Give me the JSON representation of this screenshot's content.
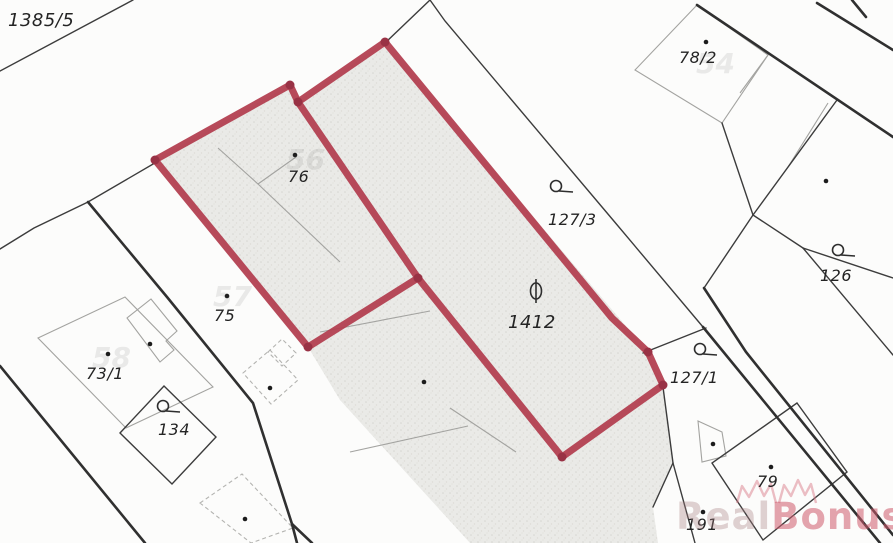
{
  "map": {
    "type": "cadastral-map",
    "labels": {
      "p1385_5": "1385/5",
      "p78_2": "78/2",
      "p76": "76",
      "p127_3": "127/3",
      "p126": "126",
      "p75": "75",
      "p73_1": "73/1",
      "p134": "134",
      "p1412": "1412",
      "p127_1": "127/1",
      "p79": "79",
      "p191": "191"
    },
    "faint_building_numbers": {
      "f56": "56",
      "f57": "57",
      "f58": "58",
      "f54": "54"
    },
    "symbols": [
      {
        "name": "circle-flag-symbol",
        "near_parcel": "127/3"
      },
      {
        "name": "circle-flag-symbol",
        "near_parcel": "126"
      },
      {
        "name": "circle-flag-symbol",
        "near_parcel": "134"
      },
      {
        "name": "circle-flag-symbol",
        "near_parcel": "127/1"
      },
      {
        "name": "theta-symbol",
        "near_parcel": "1412"
      }
    ],
    "highlighted_parcels": [
      "76-area",
      "1412-strip"
    ],
    "colors": {
      "highlight_red": "#b23c4e",
      "highlight_red_dark": "#993245",
      "parcel_fill_gray": "#eaeae7",
      "line_dark": "#3c3c3c",
      "line_light": "#9f9f9f",
      "watermark_pink": "#cd5a6c"
    },
    "watermark": {
      "part1": "Real",
      "part2": "Bonus",
      "part3": ".cz"
    }
  }
}
